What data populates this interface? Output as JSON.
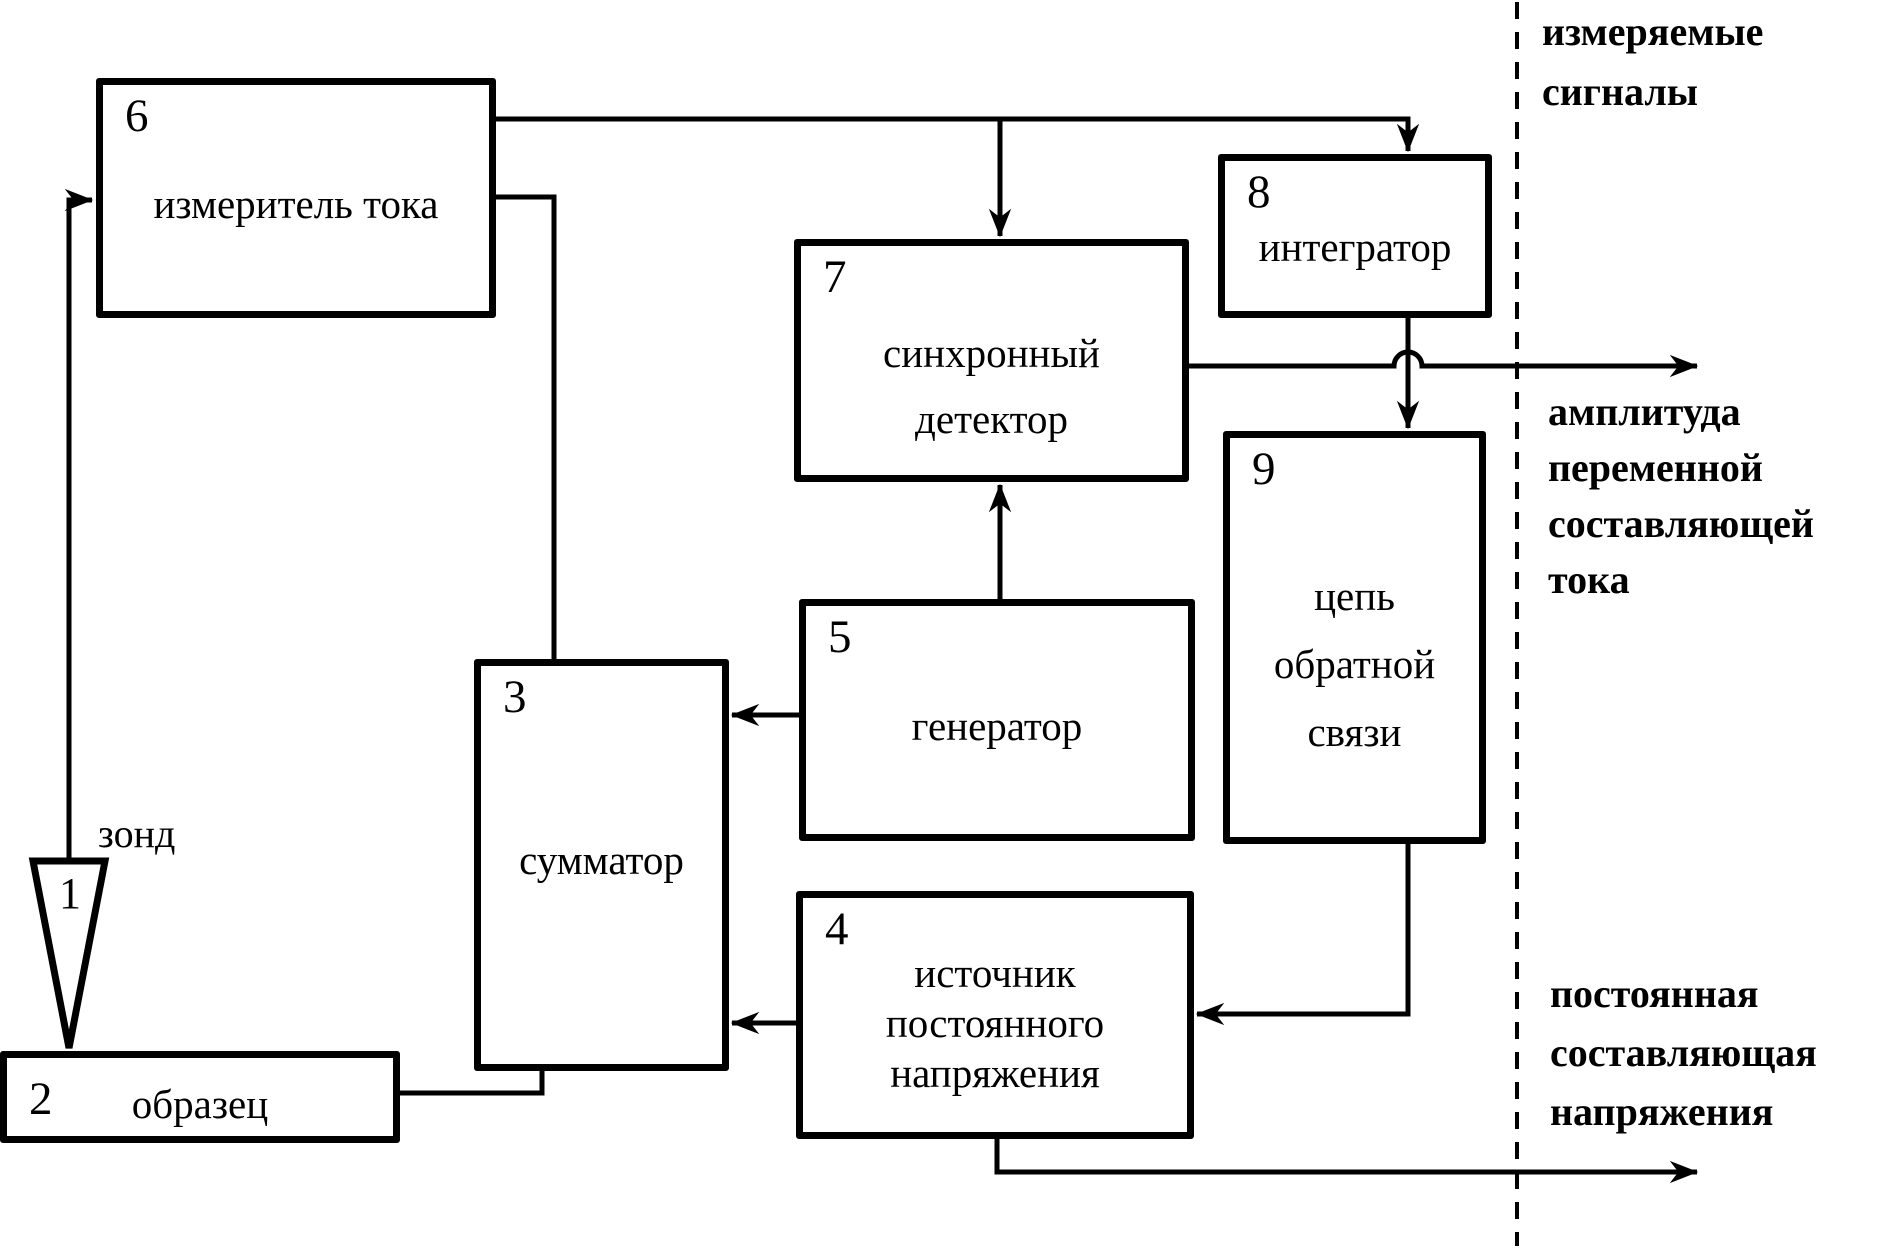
{
  "colors": {
    "ink": "#000000",
    "background": "#ffffff"
  },
  "blocks": {
    "probe": {
      "num": "1",
      "label": "зонд"
    },
    "sample": {
      "num": "2",
      "label": "образец"
    },
    "summer": {
      "num": "3",
      "label": "сумматор"
    },
    "dc_source": {
      "num": "4",
      "label": "источник постоянного напряжения"
    },
    "generator": {
      "num": "5",
      "label": "генератор"
    },
    "current_meter": {
      "num": "6",
      "label": "измеритель тока"
    },
    "sync_detector": {
      "num": "7",
      "label": "синхронный детектор"
    },
    "integrator": {
      "num": "8",
      "label": "интегратор"
    },
    "feedback": {
      "num": "9",
      "label": "цепь обратной связи"
    }
  },
  "annotations": {
    "measured_signals": "измеряемые сигналы",
    "ac_amplitude": "амплитуда переменной составляющей тока",
    "dc_voltage": "постоянная составляющая напряжения"
  },
  "connections": [
    {
      "from": "1",
      "to": "6",
      "arrowhead": true
    },
    {
      "from": "6",
      "to": "8",
      "arrowhead": true
    },
    {
      "from": "6",
      "to": "7",
      "arrowhead": true
    },
    {
      "from": "6",
      "to": "3",
      "arrowhead": false
    },
    {
      "from": "5",
      "to": "7",
      "arrowhead": true
    },
    {
      "from": "5",
      "to": "3",
      "arrowhead": true
    },
    {
      "from": "8",
      "to": "9",
      "arrowhead": true
    },
    {
      "from": "9",
      "to": "4",
      "arrowhead": true
    },
    {
      "from": "4",
      "to": "3",
      "arrowhead": true
    },
    {
      "from": "2",
      "to": "3",
      "arrowhead": false
    },
    {
      "from": "7",
      "to": "амплитуда переменной составляющей тока",
      "arrowhead": true
    },
    {
      "from": "4",
      "to": "постоянная составляющая напряжения",
      "arrowhead": true
    }
  ]
}
